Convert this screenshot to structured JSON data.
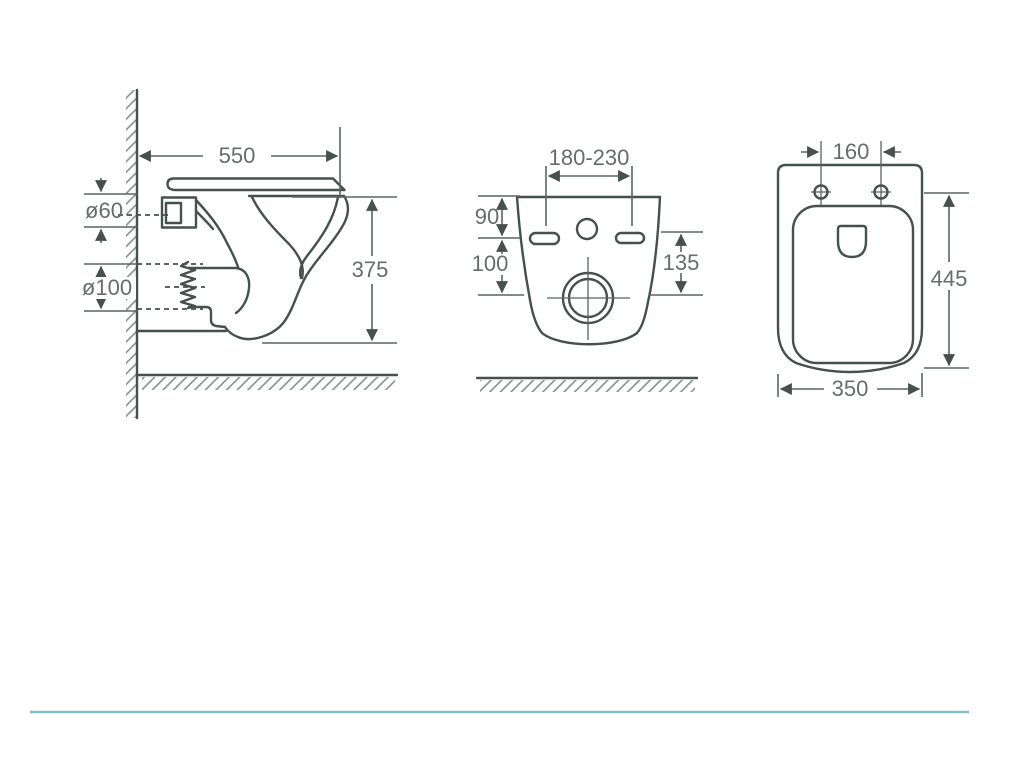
{
  "drawing": {
    "colors": {
      "line": "#45514c",
      "dimension": "#586561",
      "text": "#676d6b",
      "hatch": "#7b8984",
      "footer_divider": "#85c0cc"
    },
    "side_view": {
      "width": "550",
      "inlet_diameter": "ø60",
      "outlet_diameter": "ø100",
      "height": "375"
    },
    "front_view": {
      "bolt_hole_spacing": "180-230",
      "top_to_bolt_holes": "90",
      "bolt_holes_to_drain": "100",
      "side_span": "135"
    },
    "top_view": {
      "bolt_hole_spacing": "160",
      "depth": "445",
      "width": "350"
    }
  }
}
